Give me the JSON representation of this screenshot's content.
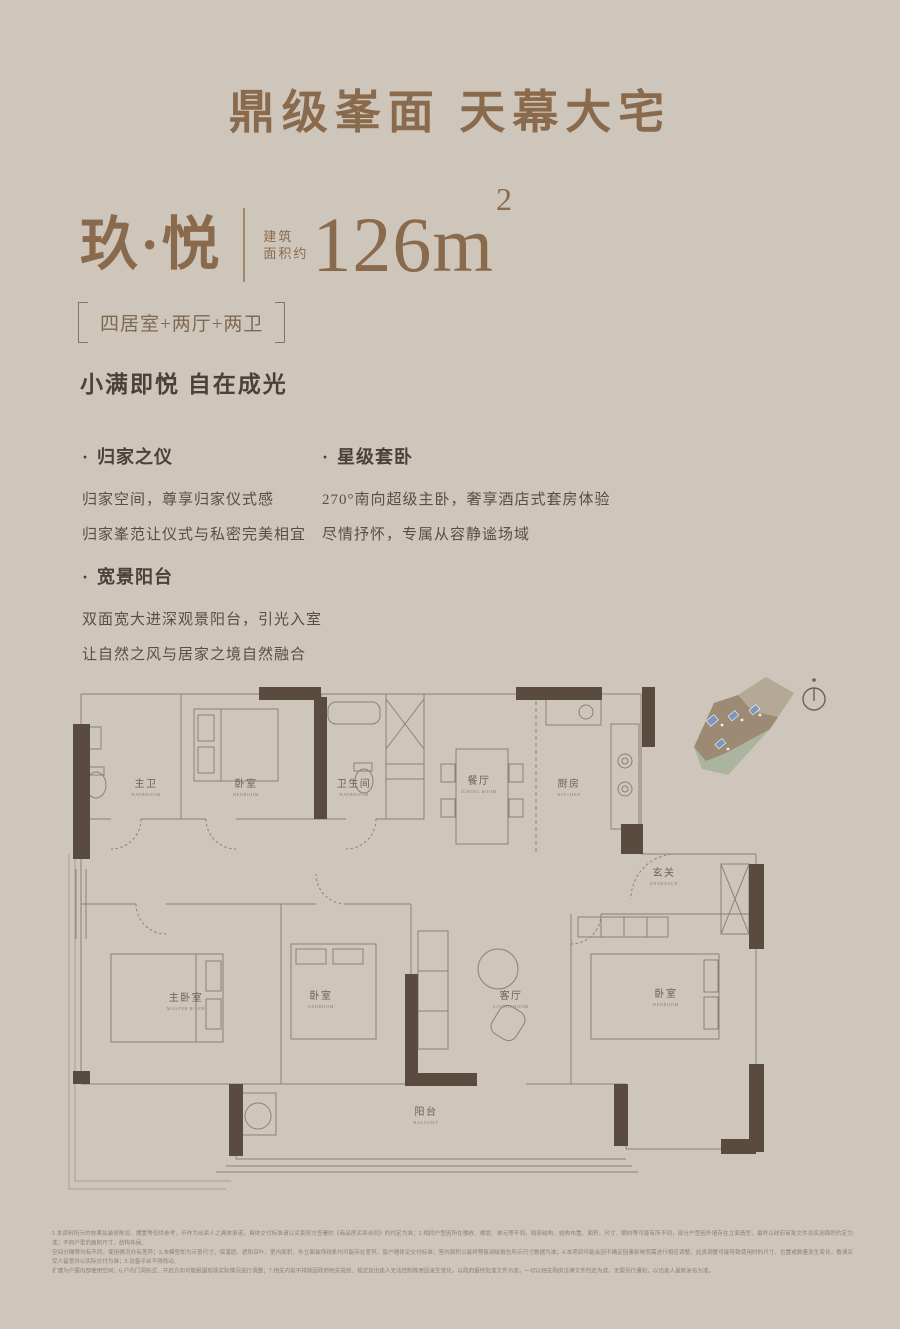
{
  "ui": {
    "bullet": "·"
  },
  "header": {
    "title": "鼎级峯面 天幕大宅"
  },
  "product": {
    "name": "玖·悦",
    "area_label_line1": "建筑",
    "area_label_line2": "面积约",
    "area_number": "126",
    "area_unit": "m",
    "area_superscript": "2",
    "layout_spec": "四居室+两厅+两卫",
    "tagline": "小满即悦 自在成光"
  },
  "features": [
    {
      "title": "归家之仪",
      "lines": [
        "归家空间，尊享归家仪式感",
        "归家峯范让仪式与私密完美相宜"
      ]
    },
    {
      "title": "星级套卧",
      "lines": [
        "270°南向超级主卧，奢享酒店式套房体验",
        "尽情抒怀，专属从容静谧场域"
      ]
    },
    {
      "title": "宽景阳台",
      "lines": [
        "双面宽大进深观景阳台，引光入室",
        "让自然之风与居家之境自然融合"
      ]
    }
  ],
  "floorplan": {
    "rooms": [
      {
        "name": "主卫",
        "en": "BATHROOM"
      },
      {
        "name": "卧室",
        "en": "BEDROOM"
      },
      {
        "name": "卫生间",
        "en": "BATHROOM"
      },
      {
        "name": "餐厅",
        "en": "DINING ROOM"
      },
      {
        "name": "厨房",
        "en": "KITCHEN"
      },
      {
        "name": "玄关",
        "en": "ENTRANCE"
      },
      {
        "name": "主卧室",
        "en": "MASTER ROOM"
      },
      {
        "name": "卧室",
        "en": "BEDROOM"
      },
      {
        "name": "客厅",
        "en": "LIVING ROOM"
      },
      {
        "name": "卧室",
        "en": "BEDROOM"
      },
      {
        "name": "阳台",
        "en": "BALCONY"
      }
    ],
    "colors": {
      "line": "#8b8173",
      "wall": "#594c3e",
      "site_green": "#abb49c",
      "site_brown": "#9c8a75",
      "site_blue": "#7b97bd"
    }
  },
  "disclaimer": {
    "lines": [
      "1.本资料所示的效果及装修陈设、摆置等仅供参考，不作为出卖人之具体承诺，具体交付标准请以买卖双方签署的《商品房买卖合同》的约定为准；2.相同户型因所在楼栋、楼层、单元等不同，局部结构、结构布置、面积、尺寸、朝向等可能有所不同，部分户型因外墙存在立面造型，最终以政府审批文件及实测面积约定为准；不同户型的面积尺寸、结构布局、",
      "空间分隔等均有不同，使用情况亦有差异；3.本模型即为示意尺寸，保温层、遮阳百叶、室内面积、外立面装饰线条均可能存在差异，窗户墙体见交付标准，室内面积以最终预售测绘报告所示尺寸数据为准；4.本项目可能会因不确定因素影响而需进行相应调整，此类调整可能导致使用时的尺寸、位置或数量发生变化，敬请买受人留意并以实际交付为准；5.设备平台不得改动、",
      "扩建为户属内部使用空间；6.户内门洞形式、开启方向可能根据现场实际情况进行调整；7.相关内容不排除因政府相关规划、规定及出卖人无法控制等原因发生变化，以政府最终批准文件为准，一切以相关购房法律文件约定为准，无需另行通知，以出卖人最新发布为准。"
    ]
  }
}
